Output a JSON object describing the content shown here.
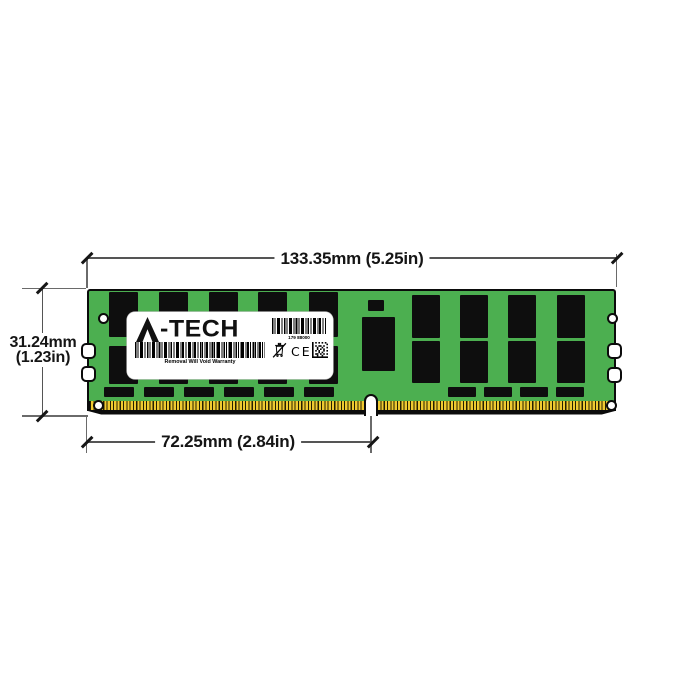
{
  "module": {
    "brand": "A-TECH",
    "brand_suffix": "-TECH",
    "label": {
      "barcode_number": "179 88000",
      "warranty_text": "Removal Will Void Warranty",
      "ce_mark": "CE"
    }
  },
  "dimensions": {
    "width": "133.35mm (5.25in)",
    "height_mm": "31.24mm",
    "height_in": "(1.23in)",
    "pin_section": "72.25mm (2.84in)"
  },
  "colors": {
    "background": "#ffffff",
    "pcb_green": "#4caf50",
    "chip_black": "#0e0e0e",
    "pin_gold": "#f0ca30",
    "pin_separator": "#261f00",
    "outline_black": "#0b0b0b",
    "dim_line_gray": "#555555",
    "text_black": "#151515",
    "label_white": "#ffffff"
  }
}
